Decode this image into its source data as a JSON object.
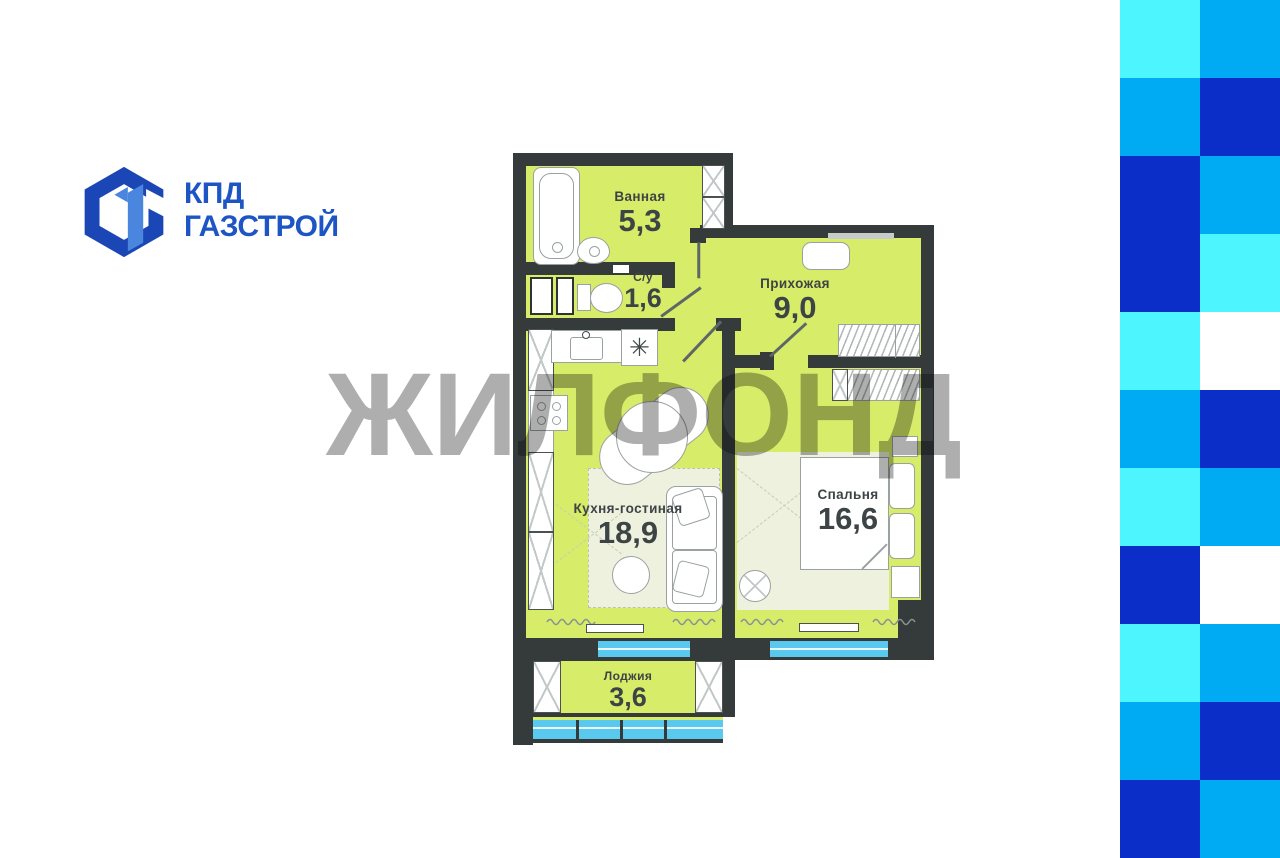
{
  "logo": {
    "line1": "КПД",
    "line2": "ГАЗСТРОЙ",
    "text_color": "#1D55C4",
    "mark_dark": "#1B46B5",
    "mark_light": "#4A86DD"
  },
  "watermark": {
    "text": "ЖИЛФОНД"
  },
  "plan": {
    "rooms": [
      {
        "name": "Ванная",
        "area": "5,3"
      },
      {
        "name": "С/у",
        "area": "1,6"
      },
      {
        "name": "Прихожая",
        "area": "9,0"
      },
      {
        "name": "Кухня-гостиная",
        "area": "18,9"
      },
      {
        "name": "Спальня",
        "area": "16,6"
      },
      {
        "name": "Лоджия",
        "area": "3,6"
      }
    ],
    "symbols": {
      "hob": "✳"
    },
    "colors": {
      "wall": "#353B3B",
      "floor": "#D7EC68",
      "carpet": "#EDF1DD",
      "window": "#5AC9F0",
      "outline": "#9AA1A1",
      "label": "#3D4446"
    }
  },
  "checker": {
    "cell_w": 80,
    "cell_h": 78,
    "palette": {
      "c": "#4DF5FF",
      "m": "#00ABF4",
      "d": "#0B2DC8",
      "w": "#FFFFFF"
    },
    "pattern": [
      [
        "c",
        "m"
      ],
      [
        "m",
        "d"
      ],
      [
        "d",
        "m"
      ],
      [
        "d",
        "c"
      ],
      [
        "c",
        "w"
      ],
      [
        "m",
        "d"
      ],
      [
        "c",
        "m"
      ],
      [
        "d",
        "w"
      ],
      [
        "c",
        "m"
      ],
      [
        "m",
        "d"
      ],
      [
        "d",
        "m"
      ]
    ]
  }
}
